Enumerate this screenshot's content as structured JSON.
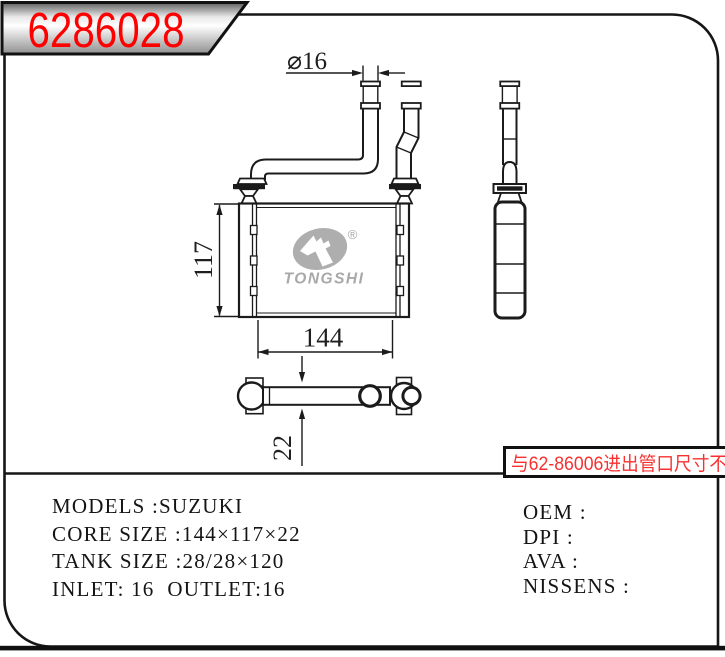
{
  "banner": {
    "part_number": "6286028",
    "number_color": "#ff0000"
  },
  "note_box": {
    "text": "与62-86006进出管口尺寸不同",
    "text_color": "#f83030"
  },
  "drawing": {
    "dimensions": {
      "pipe_diameter": "⌀16",
      "core_height": "117",
      "core_width": "144",
      "core_depth": "22"
    },
    "watermark": {
      "brand": "TONGSHI",
      "registered_mark": "®"
    }
  },
  "specs": {
    "left_lines": [
      "MODELS :SUZUKI",
      "CORE SIZE :144×117×22",
      "TANK SIZE :28/28×120",
      "INLET: 16  OUTLET:16"
    ],
    "right_lines": [
      "OEM :",
      "DPI :",
      "AVA :",
      "NISSENS :"
    ]
  }
}
